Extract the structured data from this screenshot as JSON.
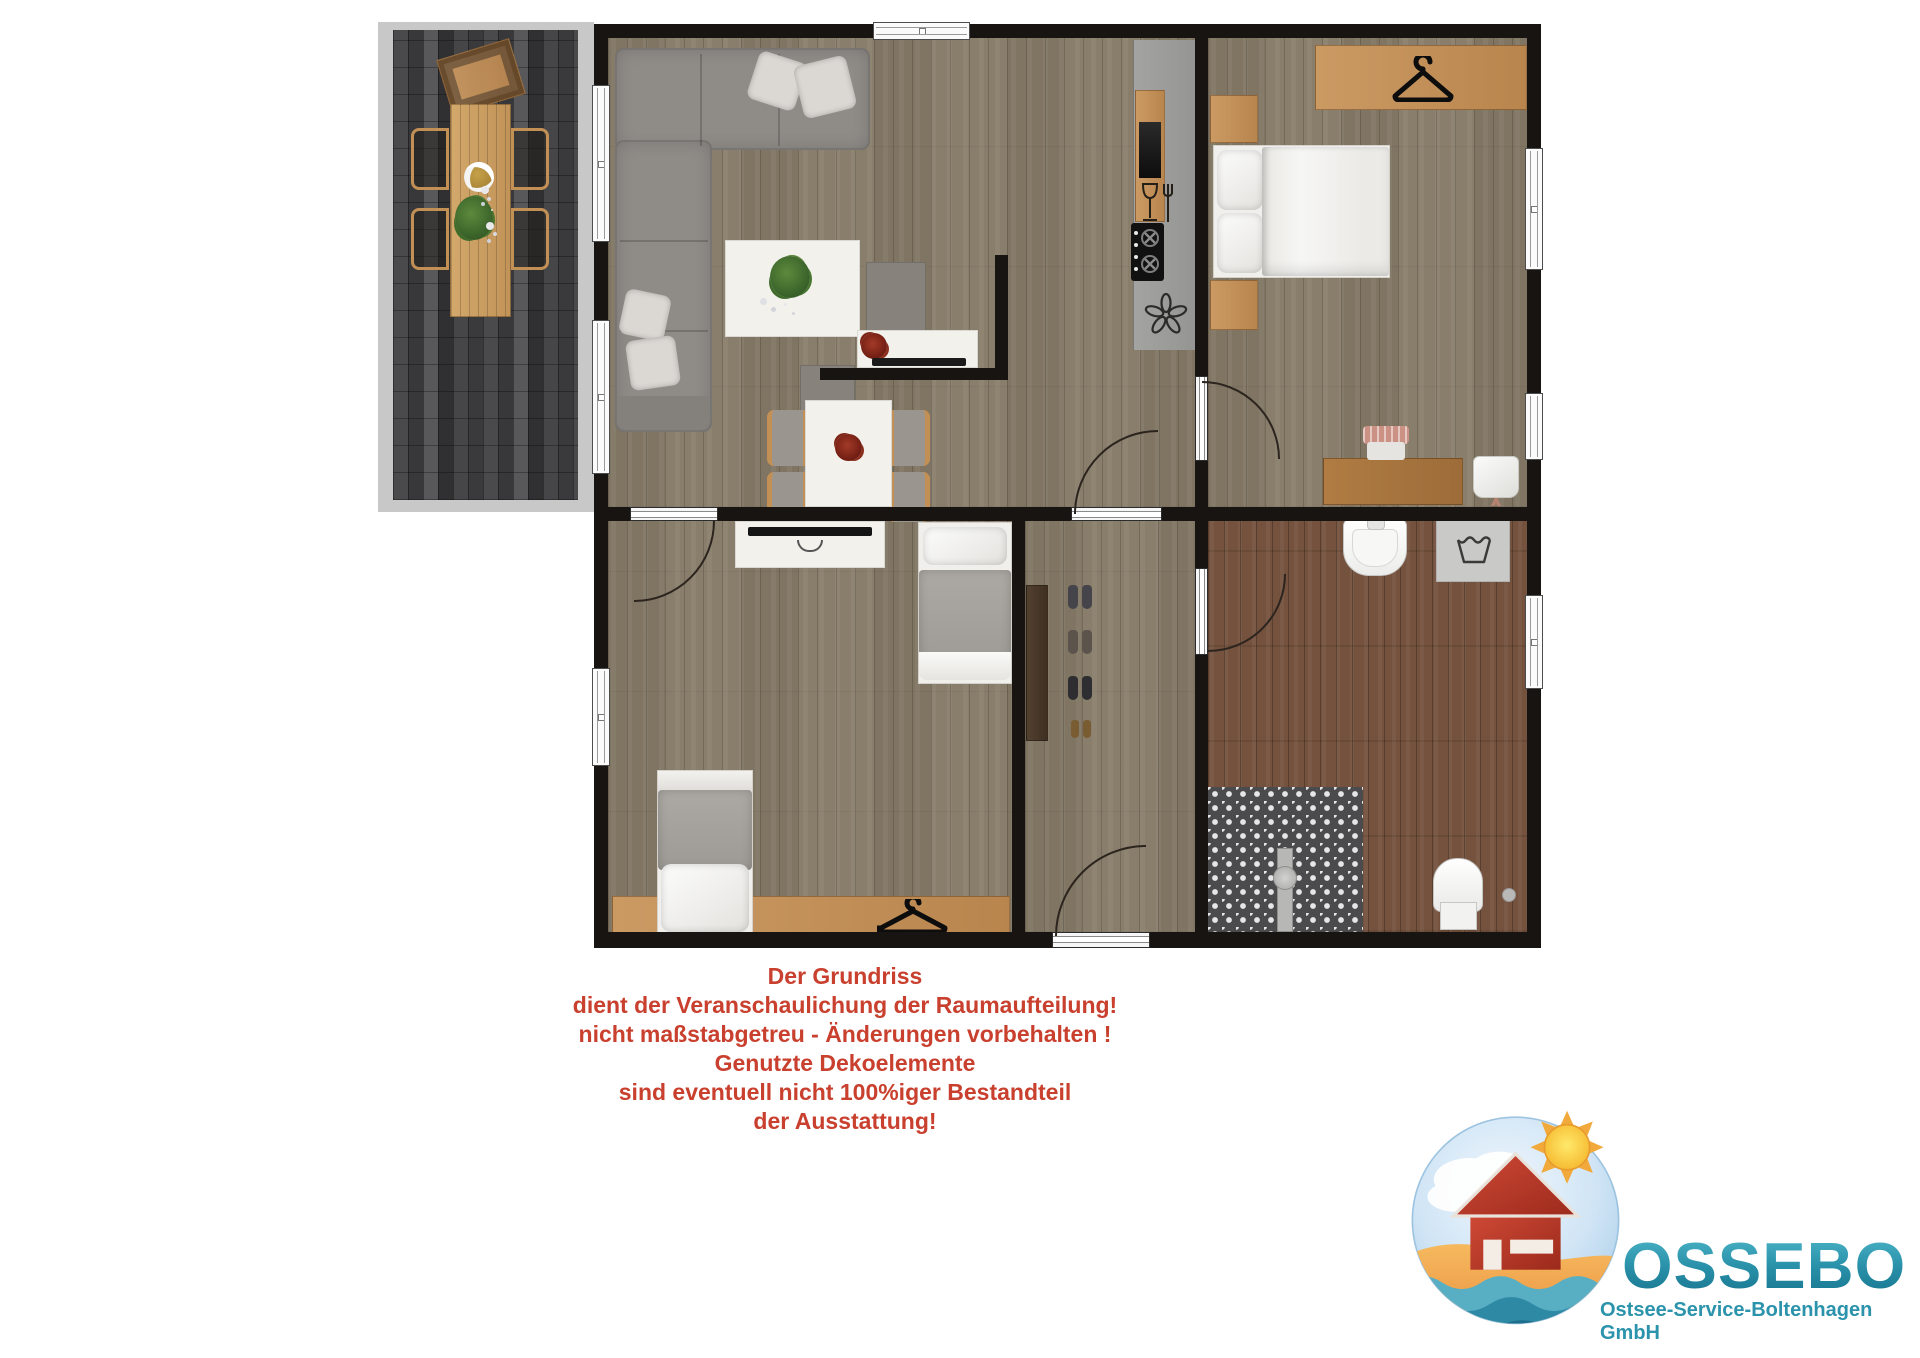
{
  "disclaimer": {
    "lines": [
      "Der Grundriss",
      "dient der Veranschaulichung der Raumaufteilung!",
      "nicht maßstabgetreu - Änderungen vorbehalten !",
      "Genutzte Dekoelemente",
      "sind eventuell nicht 100%iger Bestandteil",
      "der Ausstattung!"
    ]
  },
  "logo": {
    "title": "OSSEBO",
    "subtitle": "Ostsee-Service-Boltenhagen GmbH"
  },
  "icons": {
    "wardrobe": "hanger-icon",
    "kitchen_bar": "wine-glass-fork-icon",
    "extractor": "fan-icon",
    "washing_machine": "laundry-tub-icon"
  },
  "colors": {
    "disclaimer": "#c9402e",
    "logo_teal": "#2b93ab",
    "logo_teal_dark": "#14708b",
    "wall": "#171412",
    "floor_wood": "#897e6b",
    "floor_bath": "#74523d",
    "terrace_paver": "#3f3f41",
    "furniture_wood": "#c2905a",
    "sofa_gray": "#8f8c88",
    "logo_red_house": "#b8372a",
    "logo_sun": "#f5b72e"
  }
}
